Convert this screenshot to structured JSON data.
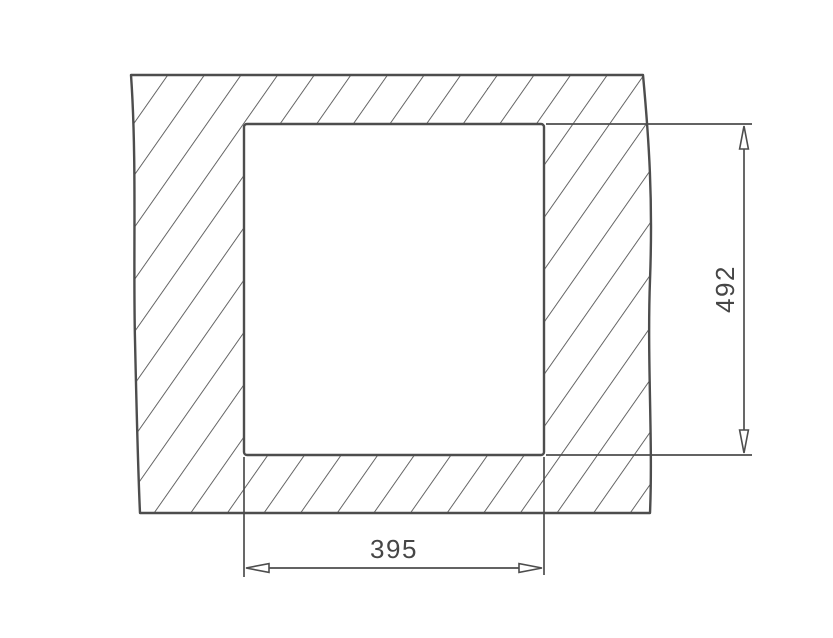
{
  "diagram": {
    "type": "installation-cutout-drawing",
    "width_dimension": {
      "label": "395"
    },
    "height_dimension": {
      "label": "492"
    },
    "colors": {
      "line": "#4d4d4d",
      "hatch": "#555555",
      "text": "#464646",
      "background": "#ffffff",
      "cutout_fill": "#ffffff"
    }
  }
}
